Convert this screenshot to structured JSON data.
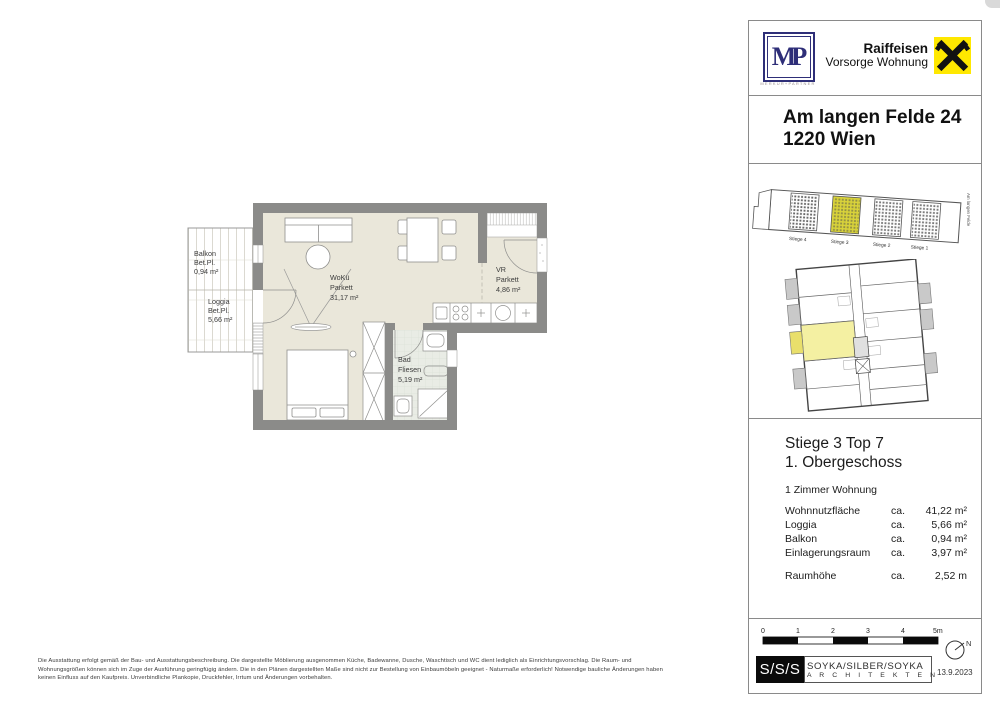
{
  "plan": {
    "rooms": {
      "balkon": {
        "line1": "Balkon",
        "line2": "Bet.Pl.",
        "line3": "0,94 m²"
      },
      "loggia": {
        "line1": "Loggia",
        "line2": "Bet.Pl.",
        "line3": "5,66 m²"
      },
      "woku": {
        "line1": "WoKü",
        "line2": "Parkett",
        "line3": "31,17 m²"
      },
      "vr": {
        "line1": "VR",
        "line2": "Parkett",
        "line3": "4,86 m²"
      },
      "bad": {
        "line1": "Bad",
        "line2": "Fliesen",
        "line3": "5,19 m²"
      }
    },
    "colors": {
      "wall": "#8b8b89",
      "floor": "#eae7da",
      "bath_floor": "#e9ece5"
    }
  },
  "panel": {
    "logos": {
      "mp_text": "MP",
      "mp_subtext": "MERKUR+PARTNER",
      "raiffeisen_line1": "Raiffeisen",
      "raiffeisen_line2": "Vorsorge Wohnung",
      "raiffeisen_yellow": "#ffe800"
    },
    "address": {
      "line1": "Am langen Felde 24",
      "line2": "1220 Wien"
    },
    "site": {
      "labels": [
        "Stiege 4",
        "Stiege 3",
        "Stiege 2",
        "Stiege 1"
      ],
      "street": "Am langen Felde",
      "highlight_color": "#d9d33a",
      "unit_highlight_color": "#f4f0a2"
    },
    "unit": {
      "title_line1": "Stiege 3 Top 7",
      "title_line2": "1. Obergeschoss",
      "type": "1 Zimmer Wohnung",
      "areas": [
        {
          "label": "Wohnnutzfläche",
          "prefix": "ca.",
          "value": "41,22 m²"
        },
        {
          "label": "Loggia",
          "prefix": "ca.",
          "value": "5,66 m²"
        },
        {
          "label": "Balkon",
          "prefix": "ca.",
          "value": "0,94 m²"
        },
        {
          "label": "Einlagerungsraum",
          "prefix": "ca.",
          "value": "3,97 m²"
        }
      ],
      "height_row": {
        "label": "Raumhöhe",
        "prefix": "ca.",
        "value": "2,52 m"
      }
    },
    "scale": {
      "ticks": [
        "0",
        "1",
        "2",
        "3",
        "4",
        "5m"
      ],
      "north_label": "N"
    },
    "architects": {
      "logo": "S/S/S",
      "name": "SOYKA/SILBER/SOYKA",
      "sub": "A R C H I T E K T E N",
      "date": "13.9.2023"
    }
  },
  "footer": {
    "lines": [
      "Die Ausstattung erfolgt gemäß der Bau- und Ausstattungsbeschreibung. Die dargestellte Möblierung ausgenommen Küche, Badewanne, Dusche, Waschtisch und WC dient lediglich als Einrichtungsvorschlag. Die Raum- und",
      "Wohnungsgrößen können sich im Zuge der Ausführung geringfügig ändern. Die in den Plänen dargestellten Maße sind nicht zur Bestellung von Einbaumöbeln geeignet - Naturmaße erforderlich! Notwendige bauliche Änderungen haben",
      "keinen Einfluss auf den Kaufpreis. Unverbindliche Plankopie, Druckfehler, Irrtum und Änderungen vorbehalten."
    ]
  }
}
